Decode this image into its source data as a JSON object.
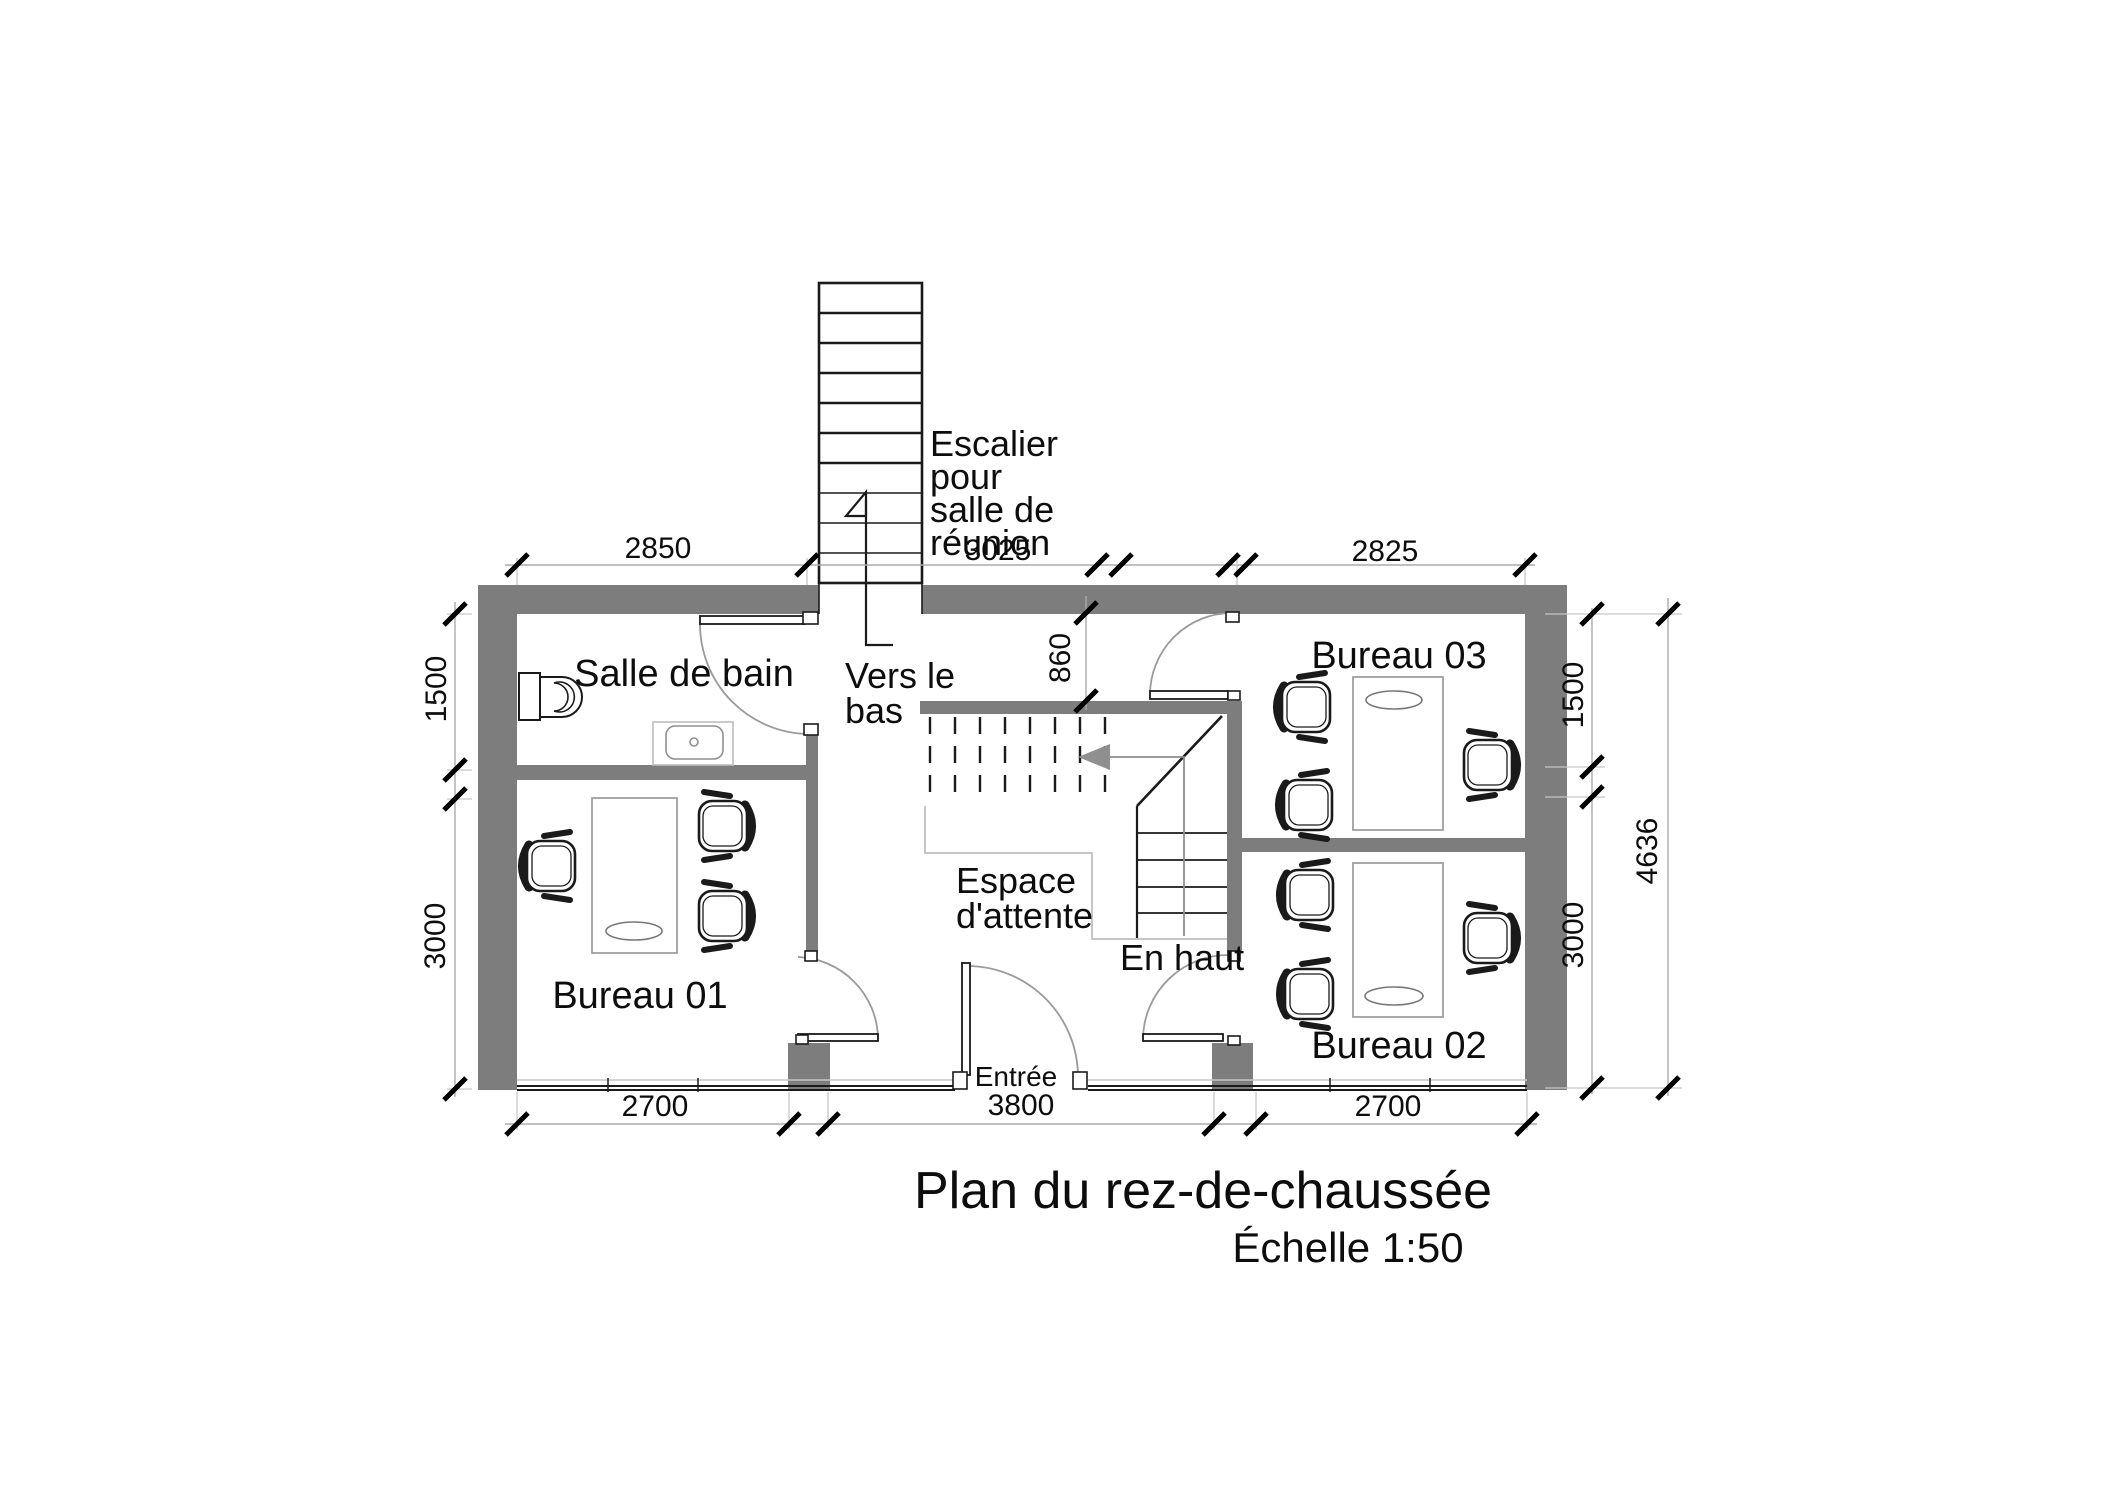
{
  "title": {
    "main": "Plan du rez-de-chaussée",
    "scale_label": "Échelle 1:50"
  },
  "rooms": {
    "bathroom": "Salle de bain",
    "office1": "Bureau 01",
    "office2": "Bureau 02",
    "office3": "Bureau 03",
    "waiting_line1": "Espace",
    "waiting_line2": "d'attente",
    "entrance": "Entrée"
  },
  "stairs": {
    "note_line1": "Escalier",
    "note_line2": "pour",
    "note_line3": "salle de",
    "note_line4": "réunion",
    "down_line1": "Vers le",
    "down_line2": "bas",
    "up_label": "En haut"
  },
  "dimensions": {
    "top": [
      "2850",
      "3025",
      "2825"
    ],
    "bottom_left": "2700",
    "bottom_center": "3800",
    "bottom_right": "2700",
    "left_upper": "1500",
    "left_lower": "3000",
    "right_upper": "1500",
    "right_lower": "3000",
    "right_overall": "4636",
    "stair_width": "860"
  },
  "colors": {
    "wall": "#7d7d7d",
    "line": "#1a1a1a",
    "light": "#c6c6c6",
    "dim": "#ababab",
    "furn": "#9a9a9a"
  }
}
